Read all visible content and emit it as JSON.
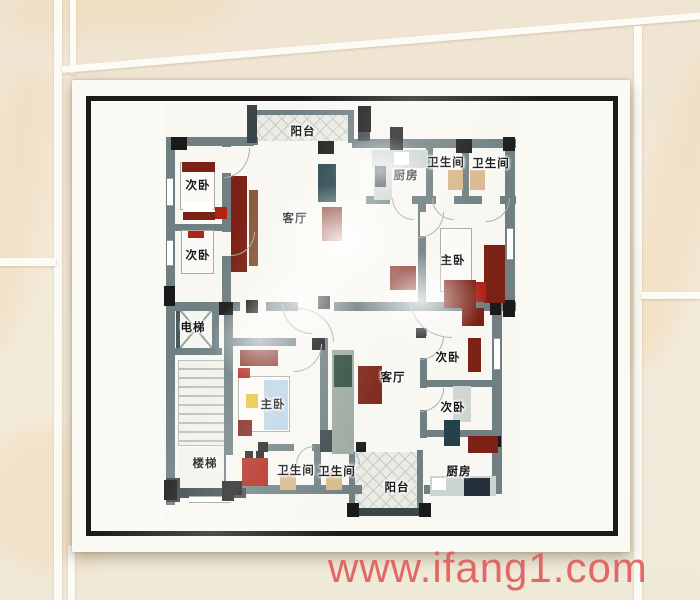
{
  "watermark": {
    "text": "www.ifang1.com",
    "color": "#de5d5d"
  },
  "colors": {
    "wall": "#6f7f82",
    "wallDark": "#3b4649",
    "column": "#1a1a1a",
    "maroon": "#7c2115",
    "red": "#b02418",
    "brown": "#8a5a3a",
    "teal": "#24424a",
    "navy": "#232f3b",
    "green": "#2e4a3c",
    "gray": "#9aa89e",
    "lightGray": "#cfd6d1",
    "counter": "#ccd4cf",
    "beige": "#d9b88a",
    "blue": "#bcd4e6",
    "yellow": "#e9c43c",
    "white": "#ffffff",
    "quilt": "#ebebe5",
    "quiltLine": "#c6cbc3",
    "stairTread": "#f2f2ec",
    "stairLine": "#b9c2b8",
    "arcLine": "#a7b0ac",
    "floor": "#f8f7f1",
    "paper": "#fbf9f3",
    "frame": "#1b1b1b",
    "label": "#141414",
    "tile": "#f2e9d8",
    "grout": "#fcfbf6"
  },
  "floor_plan": {
    "room_labels": [
      {
        "text": "阳台",
        "x": 303,
        "y": 131
      },
      {
        "text": "次卧",
        "x": 198,
        "y": 185
      },
      {
        "text": "次卧",
        "x": 198,
        "y": 255
      },
      {
        "text": "客厅",
        "x": 295,
        "y": 218
      },
      {
        "text": "厨房",
        "x": 406,
        "y": 175
      },
      {
        "text": "卫生间",
        "x": 446,
        "y": 162
      },
      {
        "text": "卫生间",
        "x": 491,
        "y": 163
      },
      {
        "text": "主卧",
        "x": 453,
        "y": 260
      },
      {
        "text": "电梯",
        "x": 193,
        "y": 327
      },
      {
        "text": "楼梯",
        "x": 205,
        "y": 463
      },
      {
        "text": "主卧",
        "x": 273,
        "y": 404
      },
      {
        "text": "客厅",
        "x": 393,
        "y": 377
      },
      {
        "text": "次卧",
        "x": 448,
        "y": 357
      },
      {
        "text": "次卧",
        "x": 453,
        "y": 407
      },
      {
        "text": "卫生间",
        "x": 296,
        "y": 470
      },
      {
        "text": "卫生间",
        "x": 337,
        "y": 471
      },
      {
        "text": "阳台",
        "x": 397,
        "y": 487
      },
      {
        "text": "厨房",
        "x": 459,
        "y": 471
      }
    ],
    "base": [
      164,
      104,
      354,
      416
    ],
    "balconies": [
      [
        254,
        113,
        94,
        28
      ],
      [
        355,
        452,
        62,
        58
      ]
    ],
    "stairs": [
      178,
      360,
      48,
      86
    ],
    "stairs_landing": [
      178,
      448,
      48,
      40
    ],
    "elevator": [
      176,
      306,
      40,
      46
    ],
    "walls": [
      [
        166,
        137,
        88,
        9
      ],
      [
        166,
        137,
        9,
        178
      ],
      [
        168,
        224,
        60,
        7
      ],
      [
        222,
        145,
        9,
        164
      ],
      [
        223,
        137,
        35,
        8
      ],
      [
        250,
        110,
        102,
        5
      ],
      [
        348,
        110,
        6,
        33
      ],
      [
        352,
        139,
        164,
        9
      ],
      [
        505,
        139,
        10,
        178
      ],
      [
        166,
        302,
        350,
        9
      ],
      [
        428,
        196,
        88,
        8
      ],
      [
        366,
        196,
        64,
        8
      ],
      [
        426,
        147,
        7,
        55
      ],
      [
        462,
        147,
        7,
        55
      ],
      [
        418,
        204,
        8,
        100
      ],
      [
        166,
        295,
        9,
        210
      ],
      [
        166,
        348,
        56,
        7
      ],
      [
        212,
        302,
        7,
        53
      ],
      [
        224,
        309,
        9,
        190
      ],
      [
        230,
        338,
        98,
        8
      ],
      [
        320,
        346,
        8,
        102
      ],
      [
        260,
        444,
        102,
        7
      ],
      [
        314,
        450,
        7,
        40
      ],
      [
        230,
        485,
        132,
        9
      ],
      [
        424,
        485,
        78,
        9
      ],
      [
        492,
        306,
        10,
        188
      ],
      [
        420,
        328,
        7,
        110
      ],
      [
        420,
        380,
        80,
        7
      ],
      [
        420,
        430,
        80,
        7
      ],
      [
        349,
        450,
        6,
        62
      ],
      [
        417,
        450,
        6,
        62
      ]
    ],
    "dark_walls": [
      [
        247,
        105,
        10,
        38
      ],
      [
        358,
        108,
        12,
        33
      ],
      [
        166,
        478,
        14,
        24
      ],
      [
        166,
        488,
        80,
        10
      ],
      [
        349,
        508,
        78,
        8
      ],
      [
        320,
        430,
        12,
        22
      ]
    ],
    "door_gaps": [
      [
        222,
        147,
        9,
        26
      ],
      [
        222,
        232,
        9,
        24
      ],
      [
        240,
        302,
        26,
        9
      ],
      [
        298,
        302,
        36,
        9
      ],
      [
        420,
        212,
        8,
        24
      ],
      [
        390,
        196,
        22,
        8
      ],
      [
        436,
        196,
        18,
        8
      ],
      [
        482,
        196,
        18,
        8
      ],
      [
        296,
        338,
        26,
        8
      ],
      [
        294,
        444,
        18,
        7
      ],
      [
        340,
        444,
        18,
        7
      ],
      [
        420,
        336,
        7,
        22
      ],
      [
        420,
        388,
        7,
        22
      ],
      [
        226,
        455,
        7,
        26
      ]
    ],
    "windows": [
      [
        167,
        178,
        6,
        28
      ],
      [
        167,
        240,
        6,
        26
      ],
      [
        507,
        228,
        6,
        32
      ],
      [
        494,
        338,
        6,
        32
      ],
      [
        189,
        496,
        42,
        7
      ]
    ],
    "columns": [
      [
        171,
        137,
        16,
        13
      ],
      [
        318,
        141,
        16,
        13
      ],
      [
        358,
        106,
        13,
        26
      ],
      [
        390,
        127,
        13,
        30
      ],
      [
        456,
        139,
        16,
        14
      ],
      [
        503,
        137,
        12,
        14
      ],
      [
        503,
        300,
        12,
        17
      ],
      [
        164,
        286,
        11,
        20
      ],
      [
        219,
        302,
        14,
        13
      ],
      [
        246,
        300,
        12,
        13
      ],
      [
        318,
        296,
        12,
        13
      ],
      [
        312,
        338,
        13,
        12
      ],
      [
        164,
        480,
        13,
        20
      ],
      [
        222,
        481,
        12,
        20
      ],
      [
        230,
        481,
        12,
        14
      ],
      [
        347,
        503,
        12,
        14
      ],
      [
        419,
        503,
        12,
        14
      ],
      [
        416,
        328,
        10,
        10
      ],
      [
        490,
        300,
        11,
        15
      ],
      [
        490,
        436,
        11,
        11
      ],
      [
        258,
        442,
        10,
        10
      ],
      [
        356,
        442,
        10,
        10
      ]
    ],
    "beds": [
      [
        180,
        162,
        35,
        48
      ],
      [
        181,
        230,
        33,
        44
      ],
      [
        440,
        228,
        32,
        64
      ],
      [
        238,
        376,
        52,
        56
      ]
    ],
    "furniture": [
      [
        182,
        162,
        33,
        10,
        "maroon"
      ],
      [
        183,
        202,
        30,
        14,
        "white"
      ],
      [
        183,
        212,
        32,
        8,
        "maroon"
      ],
      [
        188,
        231,
        16,
        7,
        "red"
      ],
      [
        264,
        380,
        24,
        50,
        "blue"
      ],
      [
        231,
        176,
        16,
        96,
        "maroon"
      ],
      [
        249,
        190,
        9,
        76,
        "brown"
      ],
      [
        215,
        207,
        12,
        12,
        "red"
      ],
      [
        318,
        164,
        18,
        38,
        "teal"
      ],
      [
        322,
        207,
        20,
        34,
        "maroon"
      ],
      [
        372,
        150,
        56,
        18,
        "counter"
      ],
      [
        394,
        152,
        15,
        13,
        "white"
      ],
      [
        374,
        160,
        18,
        40,
        "counter"
      ],
      [
        375,
        166,
        11,
        21,
        "navy"
      ],
      [
        448,
        170,
        15,
        20,
        "beige"
      ],
      [
        470,
        170,
        15,
        20,
        "beige"
      ],
      [
        484,
        245,
        21,
        58,
        "maroon"
      ],
      [
        470,
        282,
        16,
        20,
        "red"
      ],
      [
        390,
        266,
        26,
        24,
        "maroon"
      ],
      [
        444,
        280,
        32,
        28,
        "maroon"
      ],
      [
        462,
        308,
        22,
        18,
        "maroon"
      ],
      [
        240,
        350,
        38,
        16,
        "maroon"
      ],
      [
        238,
        368,
        12,
        10,
        "red"
      ],
      [
        238,
        420,
        14,
        16,
        "maroon"
      ],
      [
        246,
        394,
        12,
        14,
        "yellow"
      ],
      [
        332,
        350,
        22,
        104,
        "gray"
      ],
      [
        334,
        355,
        18,
        32,
        "green"
      ],
      [
        358,
        366,
        24,
        38,
        "maroon"
      ],
      [
        468,
        338,
        13,
        34,
        "maroon"
      ],
      [
        453,
        386,
        18,
        36,
        "lightGray"
      ],
      [
        444,
        420,
        16,
        26,
        "teal"
      ],
      [
        242,
        458,
        26,
        28,
        "red"
      ],
      [
        245,
        451,
        8,
        7,
        "column"
      ],
      [
        256,
        451,
        8,
        7,
        "column"
      ],
      [
        280,
        472,
        16,
        18,
        "beige"
      ],
      [
        326,
        472,
        16,
        18,
        "beige"
      ],
      [
        430,
        476,
        66,
        20,
        "counter"
      ],
      [
        432,
        478,
        14,
        12,
        "white"
      ],
      [
        464,
        478,
        26,
        18,
        "navy"
      ],
      [
        468,
        436,
        30,
        17,
        "maroon"
      ]
    ],
    "door_arcs": [
      [
        224,
        148,
        26,
        30,
        "br"
      ],
      [
        231,
        232,
        24,
        24,
        "br"
      ],
      [
        282,
        304,
        30,
        30,
        "bl"
      ],
      [
        298,
        308,
        36,
        34,
        "tr"
      ],
      [
        418,
        212,
        26,
        26,
        "br"
      ],
      [
        432,
        198,
        22,
        22,
        "bl"
      ],
      [
        486,
        198,
        24,
        24,
        "br"
      ],
      [
        392,
        198,
        22,
        22,
        "bl"
      ],
      [
        410,
        300,
        42,
        38,
        "bl"
      ],
      [
        294,
        344,
        28,
        28,
        "br"
      ],
      [
        296,
        446,
        18,
        18,
        "tl"
      ],
      [
        342,
        446,
        18,
        18,
        "tr"
      ],
      [
        420,
        336,
        24,
        24,
        "br"
      ],
      [
        420,
        388,
        24,
        24,
        "br"
      ]
    ]
  }
}
